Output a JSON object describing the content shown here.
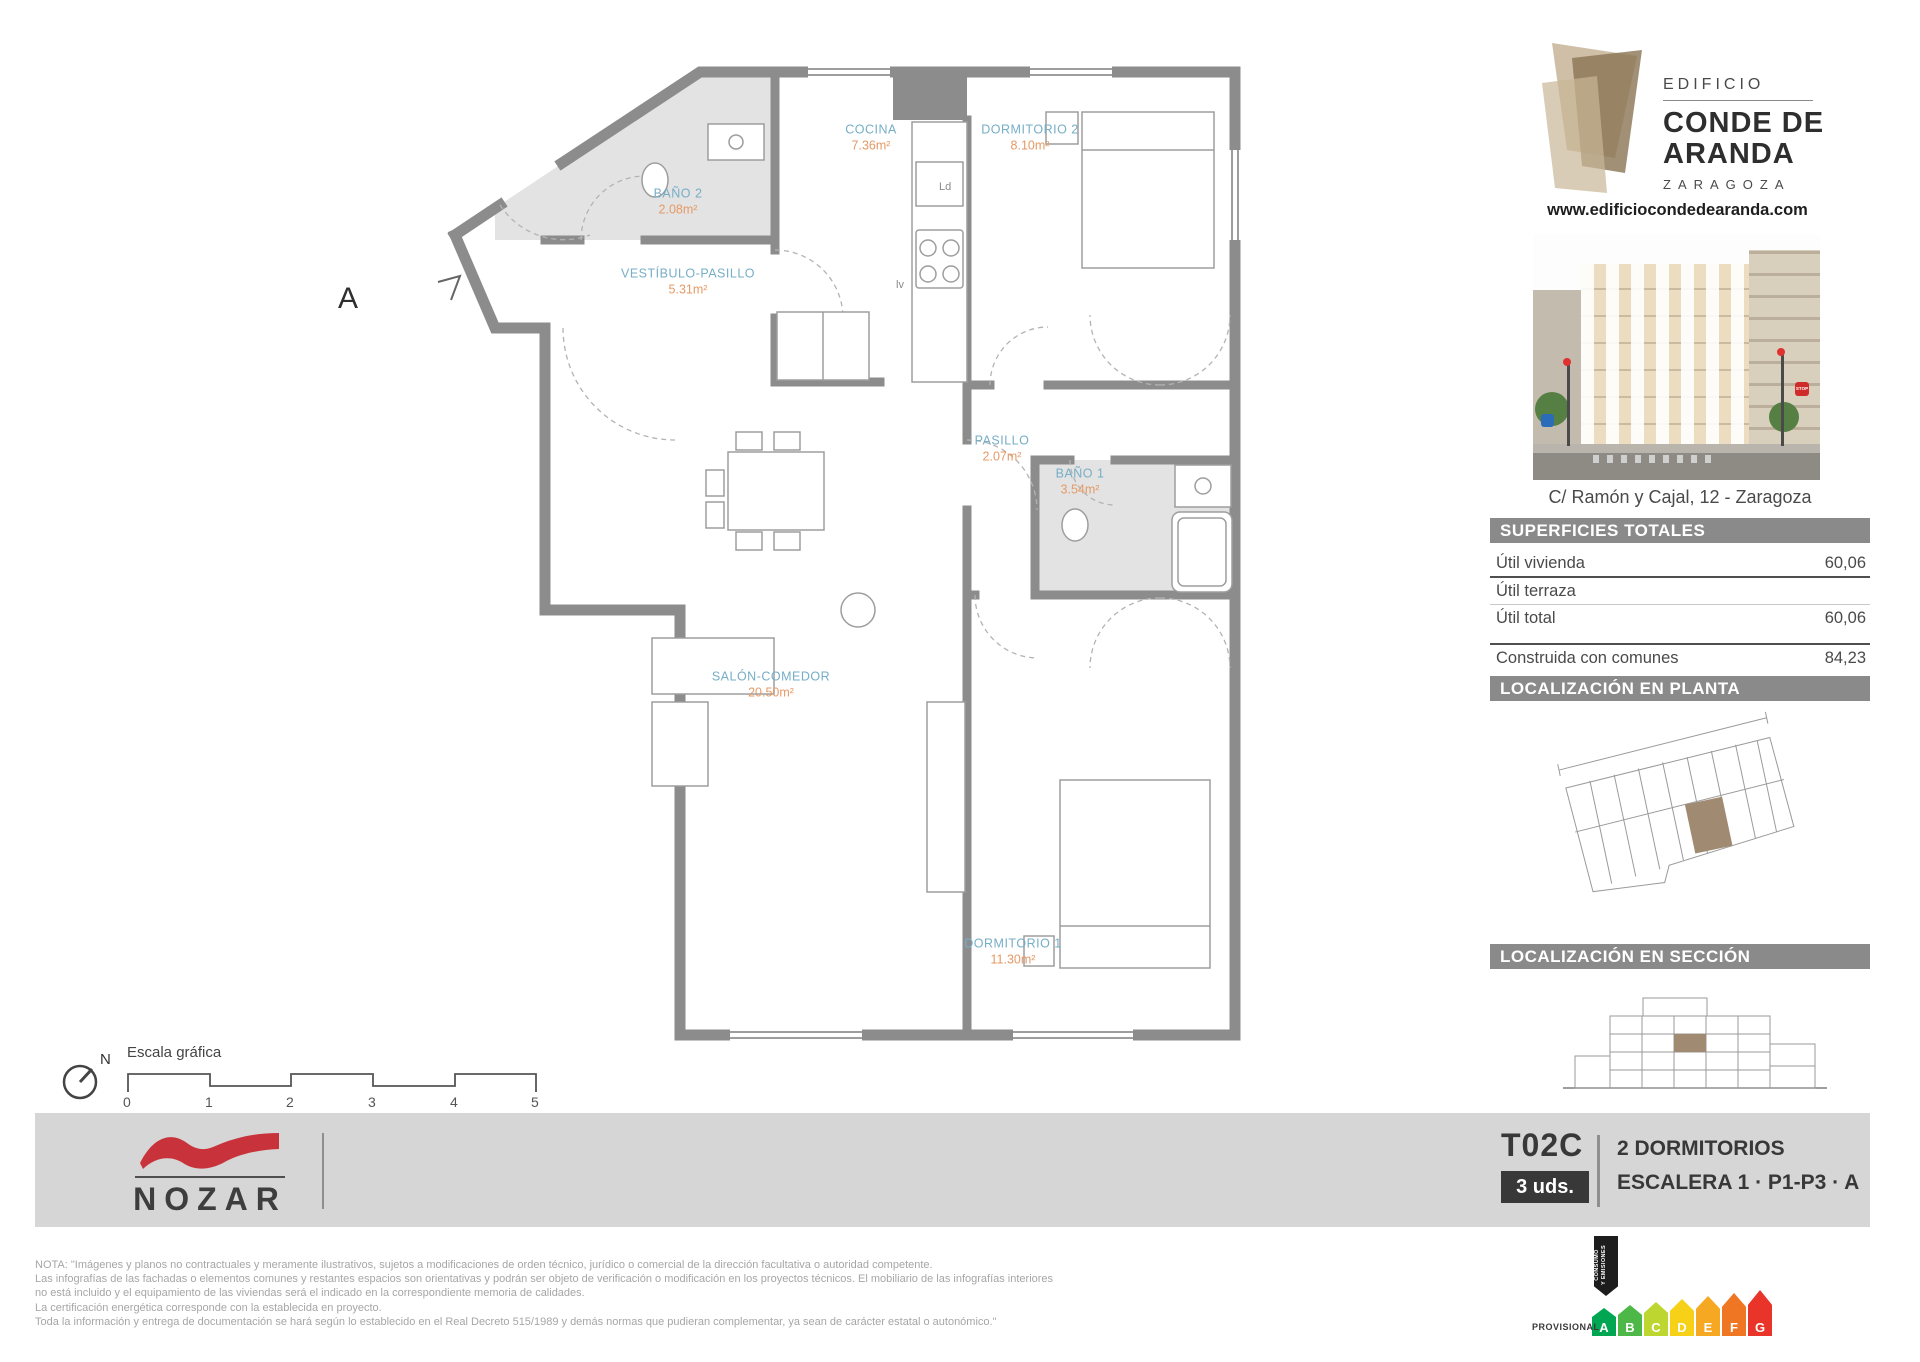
{
  "header": {
    "edificio": "EDIFICIO",
    "name_line1": "CONDE DE",
    "name_line2": "ARANDA",
    "city": "ZARAGOZA",
    "website": "www.edificiocondedearanda.com",
    "address": "C/ Ramón y Cajal, 12 - Zaragoza",
    "stop_sign": "STOP"
  },
  "plan": {
    "section_letter": "A",
    "rooms": [
      {
        "name": "BAÑO 2",
        "area": "2.08m²"
      },
      {
        "name": "COCINA",
        "area": "7.36m²"
      },
      {
        "name": "DORMITORIO 2",
        "area": "8.10m²"
      },
      {
        "name": "VESTÍBULO-PASILLO",
        "area": "5.31m²"
      },
      {
        "name": "PASILLO",
        "area": "2.07m²"
      },
      {
        "name": "BAÑO 1",
        "area": "3.54m²"
      },
      {
        "name": "SALÓN-COMEDOR",
        "area": "20.50m²"
      },
      {
        "name": "DORMITORIO 1",
        "area": "11.30m²"
      }
    ],
    "appliances": {
      "ld": "Ld",
      "lv": "lv"
    }
  },
  "surfaces": {
    "title": "SUPERFICIES TOTALES",
    "rows": [
      {
        "label": "Útil vivienda",
        "value": "60,06"
      },
      {
        "label": "Útil terraza",
        "value": ""
      },
      {
        "label": "Útil total",
        "value": "60,06"
      },
      {
        "label": "Construida con comunes",
        "value": "84,23"
      }
    ]
  },
  "location": {
    "plan_title": "LOCALIZACIÓN EN PLANTA",
    "section_title": "LOCALIZACIÓN EN SECCIÓN"
  },
  "scale_bar": {
    "north": "N",
    "label": "Escala gráfica",
    "ticks": [
      "0",
      "1",
      "2",
      "3",
      "4",
      "5"
    ]
  },
  "band": {
    "developer": "NOZAR",
    "unit_code": "T02C",
    "units_badge": "3 uds.",
    "typology": "2 DORMITORIOS",
    "location_line": "ESCALERA 1 · P1-P3 · A"
  },
  "legal": {
    "lines": [
      "NOTA: \"Imágenes y planos no contractuales y meramente ilustrativos, sujetos a modificaciones de orden técnico, jurídico o comercial de la dirección facultativa o autoridad competente.",
      "Las infografías de las fachadas o elementos comunes y restantes espacios son orientativas y podrán ser objeto de verificación o modificación en los proyectos técnicos. El mobiliario de las infografías interiores",
      "no está incluido y el equipamiento de las viviendas será el indicado en la correspondiente memoria de calidades.",
      "La certificación energética corresponde con la establecida en proyecto.",
      "Toda la información y entrega de documentación se hará según lo establecido en el Real Decreto 515/1989 y demás normas que pudieran complementar, ya sean de carácter estatal o autonómico.\""
    ]
  },
  "energy": {
    "provisional": "PROVISIONAL",
    "ribbon_line1": "CONSUMO",
    "ribbon_line2": "Y EMISIONES",
    "ratings": [
      {
        "letter": "A",
        "color": "#00a651"
      },
      {
        "letter": "B",
        "color": "#4db848"
      },
      {
        "letter": "C",
        "color": "#bed630"
      },
      {
        "letter": "D",
        "color": "#f7d117"
      },
      {
        "letter": "E",
        "color": "#f7a823"
      },
      {
        "letter": "F",
        "color": "#ef7622"
      },
      {
        "letter": "G",
        "color": "#e9342a"
      }
    ]
  },
  "colors": {
    "room_name": "#76aec6",
    "room_area": "#e59a66",
    "wall": "#8c8c8c",
    "header_bar": "#8a8a8a",
    "band": "#d6d6d6",
    "brand_red": "#c8333b",
    "unit_highlight": "#a08b72"
  }
}
